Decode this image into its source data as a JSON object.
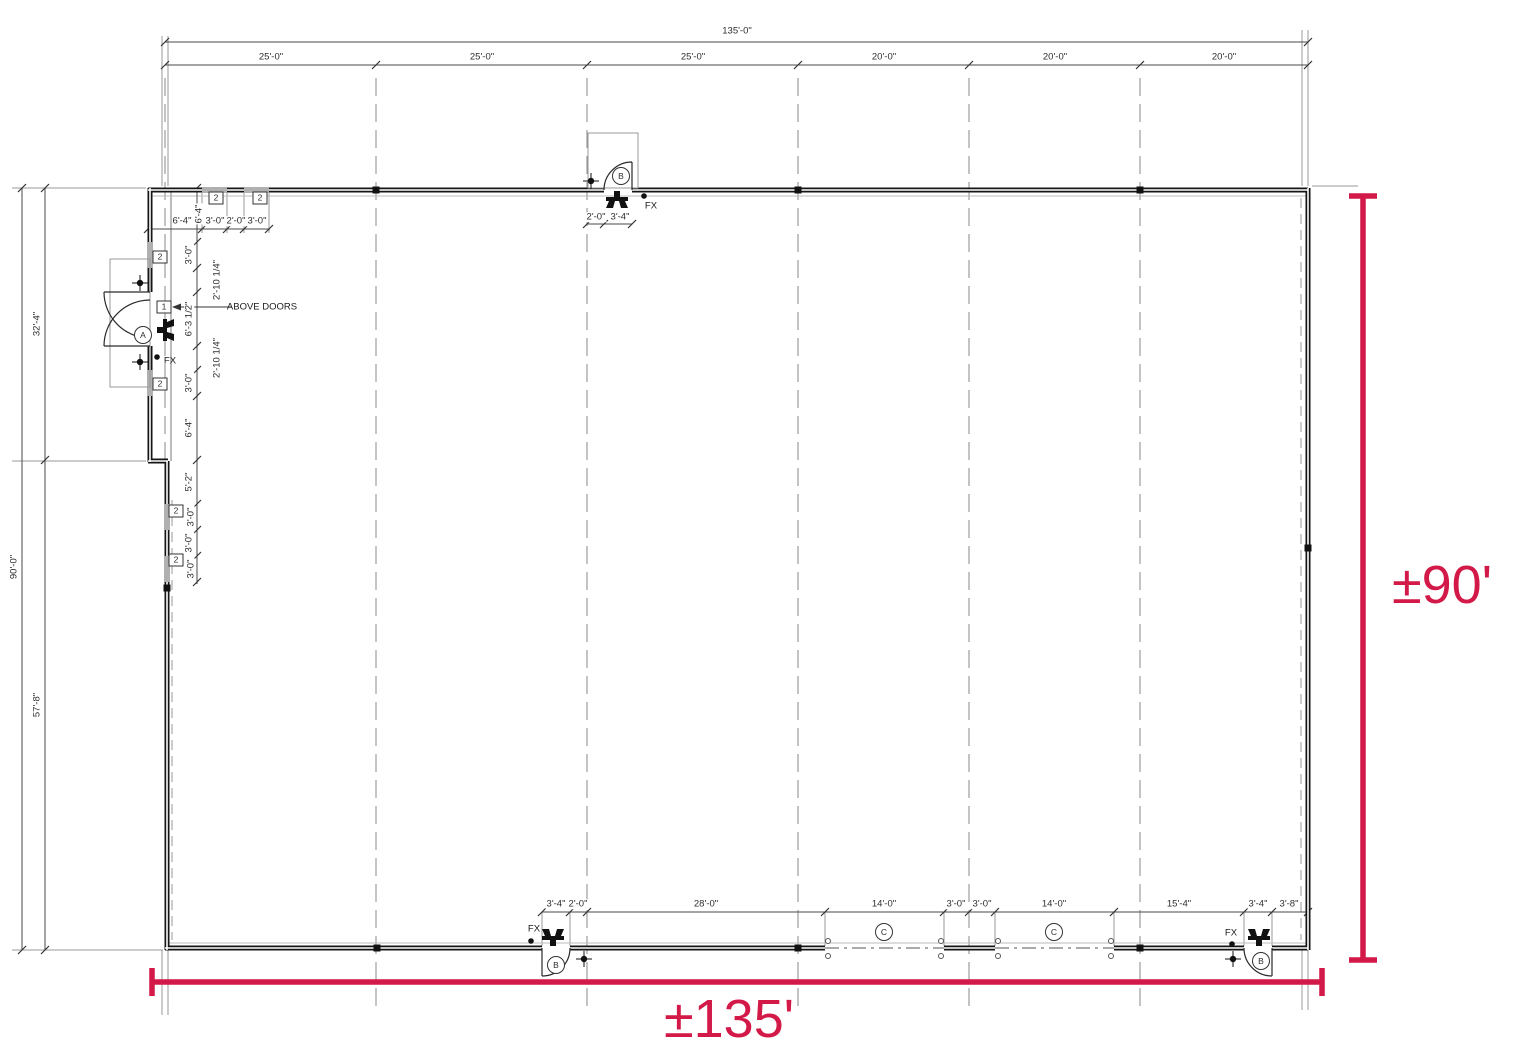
{
  "drawing": {
    "kind": "architectural floor plan",
    "overall_width_label": "±135'",
    "overall_height_label": "±90'",
    "accent_color": "#D21947",
    "overall_top_dim": "135'-0\"",
    "overall_left_dim": "90'-0\"",
    "left_segment_dims": [
      "32'-4\"",
      "57'-8\""
    ],
    "top_bay_dims": [
      "25'-0\"",
      "25'-0\"",
      "25'-0\"",
      "20'-0\"",
      "20'-0\"",
      "20'-0\""
    ],
    "bottom_chain_dims": [
      "3'-4\"",
      "2'-0\"",
      "28'-0\"",
      "14'-0\"",
      "3'-0\"",
      "3'-0\"",
      "14'-0\"",
      "15'-4\"",
      "3'-4\"",
      "3'-8\""
    ],
    "door_bubbles": [
      "A",
      "B",
      "B",
      "B",
      "C",
      "C"
    ],
    "window_tags": [
      "2",
      "1"
    ],
    "note": "ABOVE DOORS",
    "fixture_note": "FX"
  },
  "labels": [
    {
      "text": "135'-0\"",
      "x": 737,
      "y": 31,
      "name": "dim-overall-width"
    },
    {
      "text": "25'-0\"",
      "x": 271,
      "y": 57,
      "name": "dim-bay"
    },
    {
      "text": "25'-0\"",
      "x": 482,
      "y": 57,
      "name": "dim-bay"
    },
    {
      "text": "25'-0\"",
      "x": 693,
      "y": 57,
      "name": "dim-bay"
    },
    {
      "text": "20'-0\"",
      "x": 884,
      "y": 57,
      "name": "dim-bay"
    },
    {
      "text": "20'-0\"",
      "x": 1055,
      "y": 57,
      "name": "dim-bay"
    },
    {
      "text": "20'-0\"",
      "x": 1224,
      "y": 57,
      "name": "dim-bay"
    },
    {
      "text": "6'-4\"",
      "x": 182,
      "y": 221,
      "name": "dim-storefront"
    },
    {
      "text": "6'-4\"",
      "x": 199,
      "y": 214,
      "rot": -90,
      "name": "dim-storefront"
    },
    {
      "text": "3'-0\"",
      "x": 215,
      "y": 221,
      "name": "dim-window"
    },
    {
      "text": "2'-0\"",
      "x": 236,
      "y": 221,
      "name": "dim-window"
    },
    {
      "text": "3'-0\"",
      "x": 257,
      "y": 221,
      "name": "dim-window"
    },
    {
      "text": "3'-0\"",
      "x": 189,
      "y": 255,
      "rot": -90,
      "name": "dim-west-wall"
    },
    {
      "text": "2'-10 1/4\"",
      "x": 217,
      "y": 280,
      "rot": -90,
      "name": "dim-west-wall"
    },
    {
      "text": "6'-3 1/2\"",
      "x": 189,
      "y": 319,
      "rot": -90,
      "name": "dim-west-wall"
    },
    {
      "text": "2'-10 1/4\"",
      "x": 217,
      "y": 358,
      "rot": -90,
      "name": "dim-west-wall"
    },
    {
      "text": "3'-0\"",
      "x": 189,
      "y": 383,
      "rot": -90,
      "name": "dim-west-wall"
    },
    {
      "text": "6'-4\"",
      "x": 189,
      "y": 428,
      "rot": -90,
      "name": "dim-west-wall"
    },
    {
      "text": "5'-2\"",
      "x": 189,
      "y": 482,
      "rot": -90,
      "name": "dim-west-wall"
    },
    {
      "text": "3'-0\"",
      "x": 191,
      "y": 517,
      "rot": -90,
      "name": "dim-west-wall"
    },
    {
      "text": "3'-0\"",
      "x": 189,
      "y": 543,
      "rot": -90,
      "name": "dim-west-wall"
    },
    {
      "text": "3'-0\"",
      "x": 191,
      "y": 569,
      "rot": -90,
      "name": "dim-west-wall"
    },
    {
      "text": "90'-0\"",
      "x": 14,
      "y": 567,
      "rot": -90,
      "name": "dim-overall-height"
    },
    {
      "text": "32'-4\"",
      "x": 37,
      "y": 324,
      "rot": -90,
      "name": "dim-left-segment"
    },
    {
      "text": "57'-8\"",
      "x": 37,
      "y": 705,
      "rot": -90,
      "name": "dim-left-segment"
    },
    {
      "text": "2'-0\"",
      "x": 596,
      "y": 217,
      "name": "dim-top-door"
    },
    {
      "text": "3'-4\"",
      "x": 620,
      "y": 217,
      "name": "dim-top-door"
    },
    {
      "text": "3'-4\"",
      "x": 556,
      "y": 904,
      "name": "dim-bottom-chain"
    },
    {
      "text": "2'-0\"",
      "x": 578,
      "y": 904,
      "name": "dim-bottom-chain"
    },
    {
      "text": "28'-0\"",
      "x": 706,
      "y": 904,
      "name": "dim-bottom-chain"
    },
    {
      "text": "14'-0\"",
      "x": 884,
      "y": 904,
      "name": "dim-bottom-chain"
    },
    {
      "text": "3'-0\"",
      "x": 956,
      "y": 904,
      "name": "dim-bottom-chain"
    },
    {
      "text": "3'-0\"",
      "x": 982,
      "y": 904,
      "name": "dim-bottom-chain"
    },
    {
      "text": "14'-0\"",
      "x": 1054,
      "y": 904,
      "name": "dim-bottom-chain"
    },
    {
      "text": "15'-4\"",
      "x": 1179,
      "y": 904,
      "name": "dim-bottom-chain"
    },
    {
      "text": "3'-4\"",
      "x": 1258,
      "y": 904,
      "name": "dim-bottom-chain"
    },
    {
      "text": "3'-8\"",
      "x": 1289,
      "y": 904,
      "name": "dim-bottom-chain"
    },
    {
      "text": "2",
      "x": 216,
      "y": 198,
      "cls": "tag",
      "name": "window-tag"
    },
    {
      "text": "2",
      "x": 260,
      "y": 198,
      "cls": "tag",
      "name": "window-tag"
    },
    {
      "text": "2",
      "x": 160,
      "y": 257,
      "cls": "tag",
      "name": "window-tag"
    },
    {
      "text": "1",
      "x": 164,
      "y": 307,
      "cls": "tag",
      "name": "door-number-tag"
    },
    {
      "text": "2",
      "x": 160,
      "y": 384,
      "cls": "tag",
      "name": "window-tag"
    },
    {
      "text": "2",
      "x": 176,
      "y": 511,
      "cls": "tag",
      "name": "window-tag"
    },
    {
      "text": "2",
      "x": 176,
      "y": 560,
      "cls": "tag",
      "name": "window-tag"
    },
    {
      "text": "A",
      "x": 143,
      "y": 335,
      "cls": "circ",
      "name": "door-bubble-a"
    },
    {
      "text": "B",
      "x": 621,
      "y": 176,
      "cls": "circ",
      "name": "door-bubble-b"
    },
    {
      "text": "B",
      "x": 556,
      "y": 965,
      "cls": "circ",
      "name": "door-bubble-b"
    },
    {
      "text": "B",
      "x": 1261,
      "y": 961,
      "cls": "circ",
      "name": "door-bubble-b"
    },
    {
      "text": "C",
      "x": 884,
      "y": 932,
      "cls": "circ",
      "name": "overhead-door-bubble-c"
    },
    {
      "text": "C",
      "x": 1054,
      "y": 932,
      "cls": "circ",
      "name": "overhead-door-bubble-c"
    },
    {
      "text": "FX",
      "x": 651,
      "y": 206,
      "cls": "fx",
      "name": "fixture-label"
    },
    {
      "text": "FX",
      "x": 170,
      "y": 361,
      "cls": "fx",
      "name": "fixture-label"
    },
    {
      "text": "FX",
      "x": 534,
      "y": 929,
      "cls": "fx",
      "name": "fixture-label"
    },
    {
      "text": "FX",
      "x": 1231,
      "y": 933,
      "cls": "fx",
      "name": "fixture-label"
    },
    {
      "text": "ABOVE DOORS",
      "x": 262,
      "y": 307,
      "cls": "note",
      "name": "note-above-doors"
    }
  ]
}
